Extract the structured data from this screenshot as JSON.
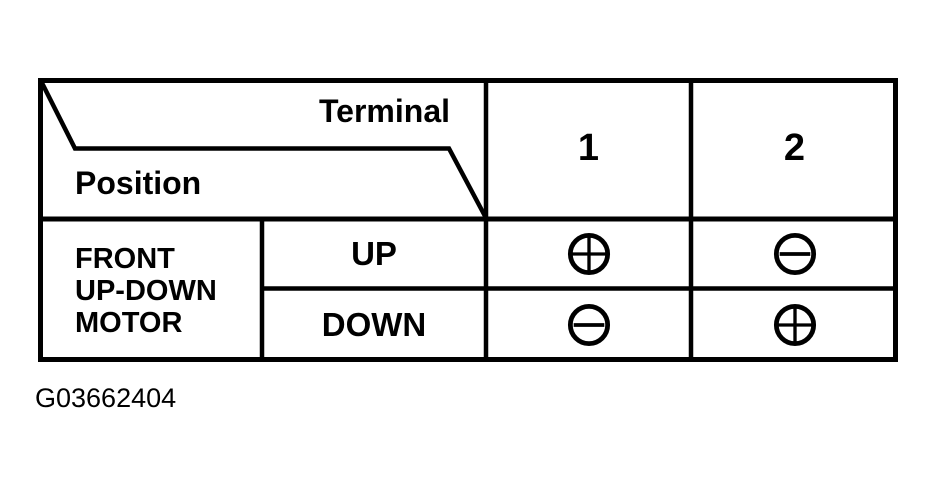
{
  "colors": {
    "ink": "#000000",
    "background": "#ffffff"
  },
  "table": {
    "header": {
      "terminal_label": "Terminal",
      "position_label": "Position",
      "columns": [
        "1",
        "2"
      ]
    },
    "body": {
      "group_label_lines": [
        "FRONT",
        "UP-DOWN",
        "MOTOR"
      ],
      "rows": [
        {
          "position": "UP",
          "terminals": [
            "plus",
            "minus"
          ]
        },
        {
          "position": "DOWN",
          "terminals": [
            "minus",
            "plus"
          ]
        }
      ]
    }
  },
  "caption": "G03662404"
}
